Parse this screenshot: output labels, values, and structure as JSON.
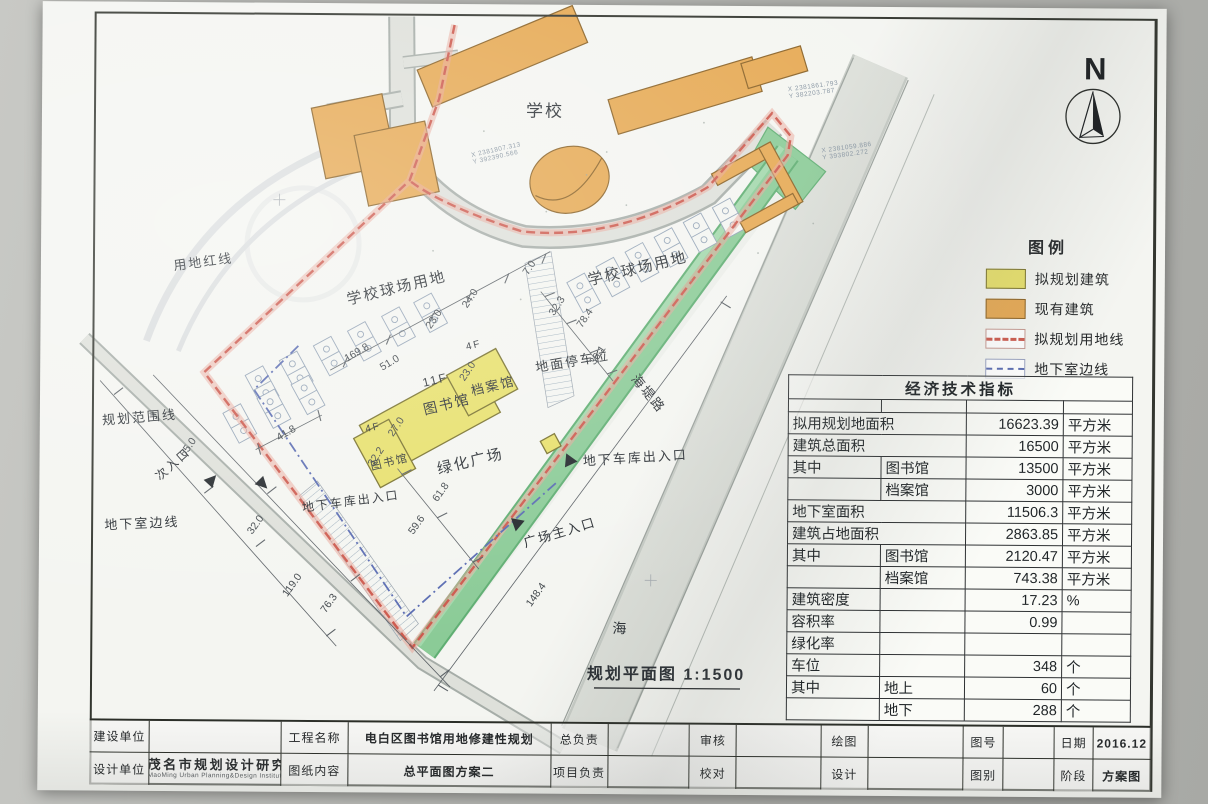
{
  "legend": {
    "title": "图例",
    "items": [
      {
        "label": "拟规划建筑",
        "type": "fill",
        "color": "#e7e06b",
        "border": "#7a7330"
      },
      {
        "label": "现有建筑",
        "type": "fill",
        "color": "#e6a953",
        "border": "#8a6226"
      },
      {
        "label": "拟规划用地线",
        "type": "dash-red",
        "color": "#cd5a4e"
      },
      {
        "label": "地下室边线",
        "type": "dash-blue",
        "color": "#5a6cb2"
      }
    ]
  },
  "north": {
    "label": "N"
  },
  "indicators_table": {
    "title": "经济技术指标",
    "rows": [
      {
        "name": "拟用规划地面积",
        "sub": "",
        "value": "16623.39",
        "unit": "平方米",
        "span": true
      },
      {
        "name": "建筑总面积",
        "sub": "",
        "value": "16500",
        "unit": "平方米",
        "span": true
      },
      {
        "name": "其中",
        "sub": "图书馆",
        "value": "13500",
        "unit": "平方米",
        "span": false
      },
      {
        "name": "",
        "sub": "档案馆",
        "value": "3000",
        "unit": "平方米",
        "span": false
      },
      {
        "name": "地下室面积",
        "sub": "",
        "value": "11506.3",
        "unit": "平方米",
        "span": true
      },
      {
        "name": "建筑占地面积",
        "sub": "",
        "value": "2863.85",
        "unit": "平方米",
        "span": true
      },
      {
        "name": "其中",
        "sub": "图书馆",
        "value": "2120.47",
        "unit": "平方米",
        "span": false
      },
      {
        "name": "",
        "sub": "档案馆",
        "value": "743.38",
        "unit": "平方米",
        "span": false
      },
      {
        "name": "建筑密度",
        "sub": "",
        "value": "17.23",
        "unit": "%",
        "span": false
      },
      {
        "name": "容积率",
        "sub": "",
        "value": "0.99",
        "unit": "",
        "span": false
      },
      {
        "name": "绿化率",
        "sub": "",
        "value": "",
        "unit": "",
        "span": false
      },
      {
        "name": "车位",
        "sub": "",
        "value": "348",
        "unit": "个",
        "span": false
      },
      {
        "name": "其中",
        "sub": "地上",
        "value": "60",
        "unit": "个",
        "span": false
      },
      {
        "name": "",
        "sub": "地下",
        "value": "288",
        "unit": "个",
        "span": false
      }
    ]
  },
  "title_block": {
    "rows": [
      [
        {
          "label": "建设单位",
          "value": ""
        },
        {
          "label": "工程名称",
          "value": "电白区图书馆用地修建性规划"
        },
        {
          "label": "总负责",
          "value": ""
        },
        {
          "label": "审核",
          "value": ""
        },
        {
          "label": "绘图",
          "value": ""
        },
        {
          "label": "图号",
          "value": ""
        },
        {
          "label": "日期",
          "value": "2016.12"
        }
      ],
      [
        {
          "label": "设计单位",
          "value": "茂名市规划设计研究院",
          "sub": "MaoMing Urban Planning&Design Institute",
          "logo": true
        },
        {
          "label": "图纸内容",
          "value": "总平面图方案二"
        },
        {
          "label": "项目负责",
          "value": ""
        },
        {
          "label": "校对",
          "value": ""
        },
        {
          "label": "设计",
          "value": ""
        },
        {
          "label": "图别",
          "value": ""
        },
        {
          "label": "阶段",
          "value": "方案图"
        }
      ]
    ]
  },
  "plan": {
    "scale_text": "规划平面图 1:1500",
    "colors": {
      "proposed_building": "#e7e06b",
      "existing_building": "#e6a953",
      "boundary_line": "#cd5a4e",
      "basement_line": "#5a6cb2",
      "green_belt": "#8bcb97"
    },
    "labels": [
      {
        "t": "学校",
        "x": 543,
        "y": 117,
        "r": 0,
        "s": 17
      },
      {
        "t": "用地红线",
        "x": 203,
        "y": 269,
        "r": -8,
        "s": 13
      },
      {
        "t": "学校球场用地",
        "x": 397,
        "y": 294,
        "r": -14,
        "s": 15
      },
      {
        "t": "学校球场用地",
        "x": 638,
        "y": 273,
        "r": -14,
        "s": 15
      },
      {
        "t": "规划范围线",
        "x": 140,
        "y": 425,
        "r": -5,
        "s": 13
      },
      {
        "t": "次入口",
        "x": 176,
        "y": 470,
        "r": -42,
        "s": 12
      },
      {
        "t": "地下室边线",
        "x": 143,
        "y": 531,
        "r": -3,
        "s": 13
      },
      {
        "t": "地面停车位",
        "x": 573,
        "y": 366,
        "r": -10,
        "s": 13
      },
      {
        "t": "11F",
        "x": 436,
        "y": 385,
        "r": -14,
        "s": 12
      },
      {
        "t": "图书馆",
        "x": 448,
        "y": 410,
        "r": -14,
        "s": 14
      },
      {
        "t": "4F",
        "x": 474,
        "y": 349,
        "r": -14,
        "s": 10
      },
      {
        "t": "档案馆",
        "x": 494,
        "y": 391,
        "r": -14,
        "s": 13
      },
      {
        "t": "4F",
        "x": 374,
        "y": 432,
        "r": -14,
        "s": 10
      },
      {
        "t": "图书馆",
        "x": 391,
        "y": 467,
        "r": -14,
        "s": 11
      },
      {
        "t": "绿化广场",
        "x": 472,
        "y": 467,
        "r": -14,
        "s": 15
      },
      {
        "t": "地下车库出入口",
        "x": 636,
        "y": 462,
        "r": -4,
        "s": 13
      },
      {
        "t": "地下车库出入口",
        "x": 352,
        "y": 507,
        "r": -8,
        "s": 12
      },
      {
        "t": "广场主入口",
        "x": 562,
        "y": 537,
        "r": -17,
        "s": 13
      },
      {
        "t": "海堤路",
        "x": 645,
        "y": 396,
        "r": 50,
        "s": 13
      },
      {
        "t": "海",
        "x": 622,
        "y": 633,
        "r": 0,
        "s": 14
      },
      {
        "t": "规划平面图 1:1500",
        "x": 668,
        "y": 679,
        "r": 0,
        "s": 16,
        "u": true
      }
    ],
    "dims": [
      {
        "t": "169.8",
        "x": 358,
        "y": 357,
        "r": -31
      },
      {
        "t": "51.0",
        "x": 391,
        "y": 367,
        "r": -31
      },
      {
        "t": "23.0",
        "x": 436,
        "y": 322,
        "r": -57
      },
      {
        "t": "24.0",
        "x": 472,
        "y": 301,
        "r": -57
      },
      {
        "t": "7.0",
        "x": 531,
        "y": 270,
        "r": -57
      },
      {
        "t": "32.3",
        "x": 559,
        "y": 308,
        "r": -57
      },
      {
        "t": "78.4",
        "x": 587,
        "y": 320,
        "r": -57
      },
      {
        "t": "36.1",
        "x": 600,
        "y": 357,
        "r": -57
      },
      {
        "t": "41.8",
        "x": 288,
        "y": 438,
        "r": -31
      },
      {
        "t": "23.0",
        "x": 470,
        "y": 374,
        "r": -57
      },
      {
        "t": "27.0",
        "x": 399,
        "y": 430,
        "r": -57
      },
      {
        "t": "32.2",
        "x": 379,
        "y": 460,
        "r": -57
      },
      {
        "t": "65.0",
        "x": 191,
        "y": 452,
        "r": -55
      },
      {
        "t": "32.0",
        "x": 259,
        "y": 529,
        "r": -55
      },
      {
        "t": "119.0",
        "x": 296,
        "y": 589,
        "r": -55
      },
      {
        "t": "76.3",
        "x": 333,
        "y": 607,
        "r": -55
      },
      {
        "t": "61.8",
        "x": 444,
        "y": 495,
        "r": -55
      },
      {
        "t": "59.6",
        "x": 420,
        "y": 528,
        "r": -55
      },
      {
        "t": "148.4",
        "x": 540,
        "y": 597,
        "r": -55
      }
    ],
    "coords": [
      {
        "l1": "X 2381807.313",
        "l2": "Y 392390.566",
        "x": 470,
        "y": 158,
        "r": -13
      },
      {
        "l1": "X 2381861.793",
        "l2": "Y 382203.787",
        "x": 786,
        "y": 90,
        "r": -8
      },
      {
        "l1": "X 2381059.886",
        "l2": "Y 393802.272",
        "x": 820,
        "y": 151,
        "r": -8
      }
    ]
  }
}
